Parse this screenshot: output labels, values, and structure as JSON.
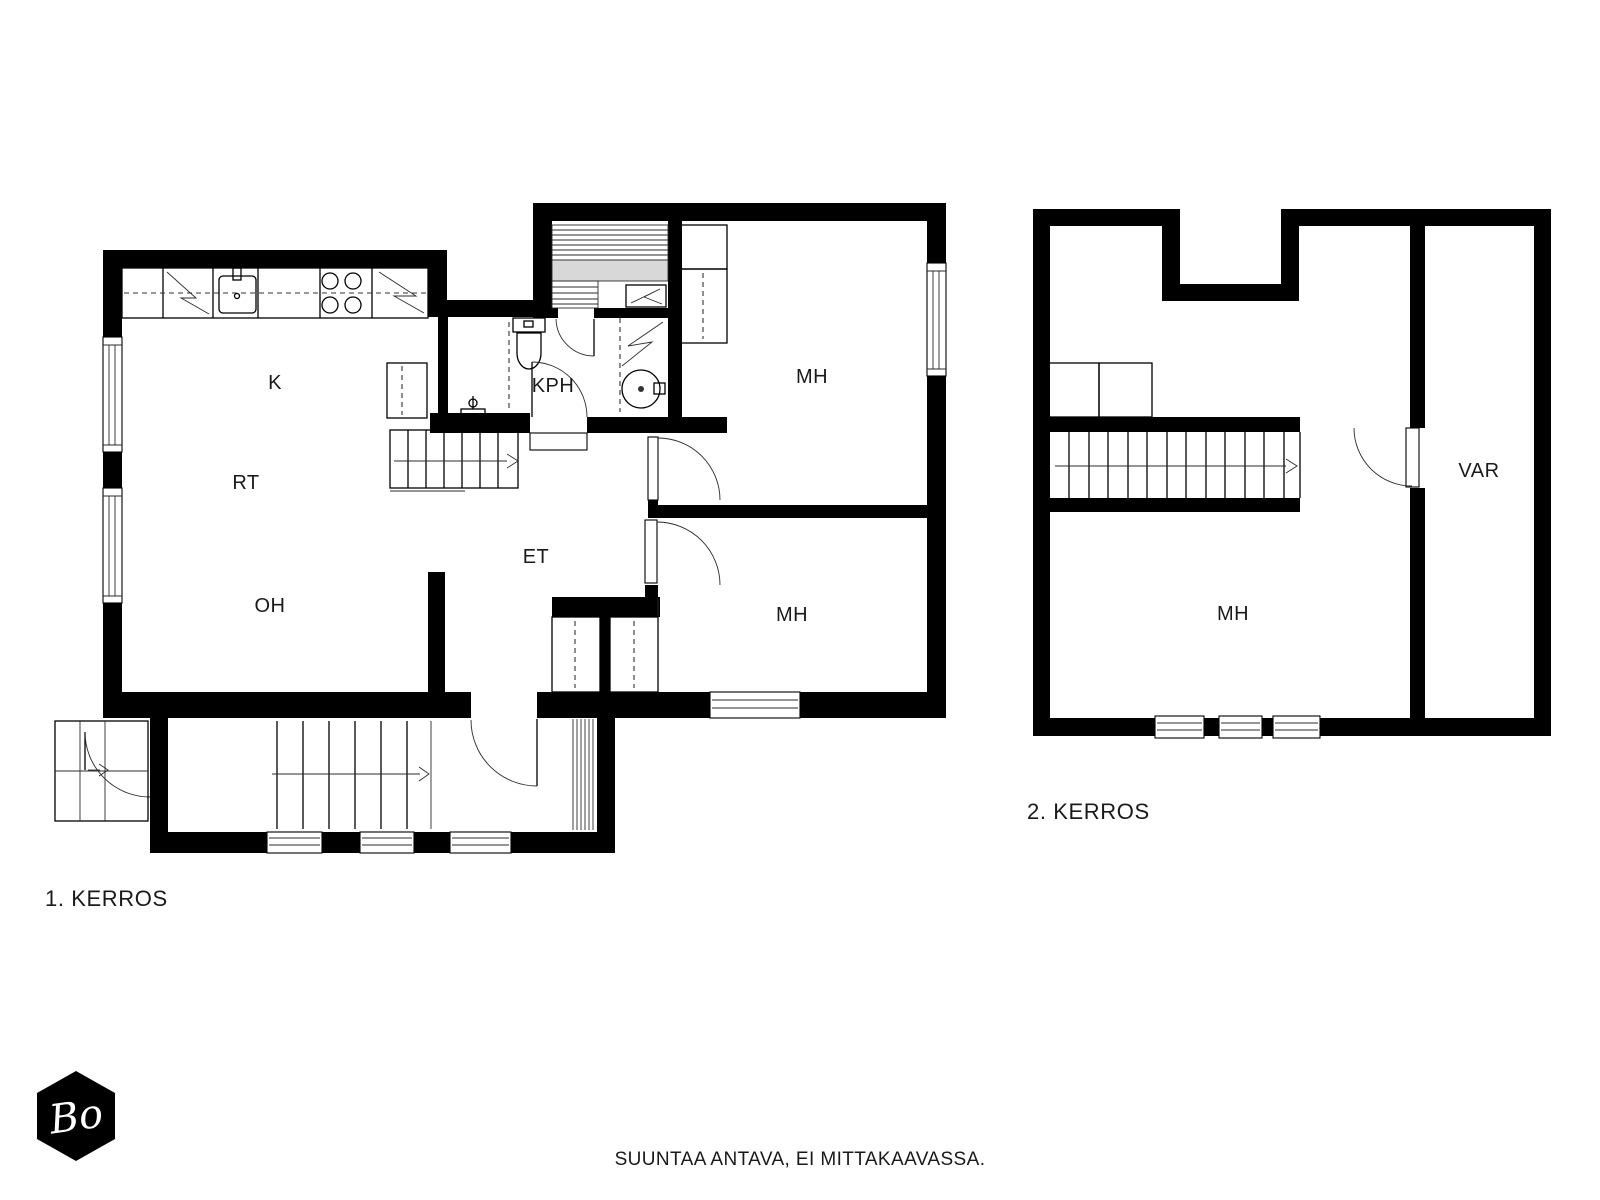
{
  "meta": {
    "disclaimer": "SUUNTAA ANTAVA, EI MITTAKAAVASSA."
  },
  "logo": {
    "text": "Bo"
  },
  "colors": {
    "wall": "#000000",
    "line": "#1a1a1a",
    "bench_fill": "#d8d8d8",
    "background": "#ffffff",
    "text": "#1a1a1a"
  },
  "floor1": {
    "caption": "1. KERROS",
    "rooms": [
      {
        "id": "kitchen",
        "label": "K"
      },
      {
        "id": "dining",
        "label": "RT"
      },
      {
        "id": "living",
        "label": "OH"
      },
      {
        "id": "hall",
        "label": "ET"
      },
      {
        "id": "bathroom",
        "label": "KPH"
      },
      {
        "id": "bedroom-upper",
        "label": "MH"
      },
      {
        "id": "bedroom-lower",
        "label": "MH"
      }
    ]
  },
  "floor2": {
    "caption": "2. KERROS",
    "rooms": [
      {
        "id": "bedroom",
        "label": "MH"
      },
      {
        "id": "storage",
        "label": "VAR"
      }
    ]
  }
}
